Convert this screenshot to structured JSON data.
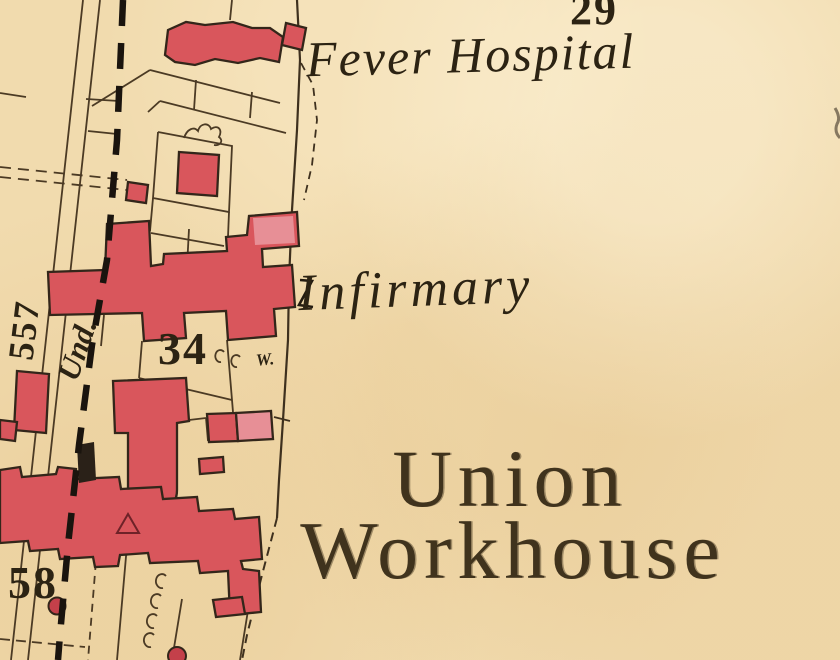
{
  "map": {
    "title_labels": {
      "fever_hospital": "Fever Hospital",
      "infirmary": "Infirmary",
      "union_workhouse_line1": "Union",
      "union_workhouse_line2": "Workhouse"
    },
    "parcel_numbers": {
      "parcel_29": "29",
      "parcel_34": "34",
      "parcel_557": "557",
      "parcel_58": "58"
    },
    "annotations": {
      "boundary_mereing": "Und.",
      "well": "W."
    },
    "colors": {
      "paper": "#f1dbae",
      "building_red": "#d9565c",
      "building_red_light": "#e78f96",
      "line_ink": "#4b3a24",
      "boundary_black": "#1a140e",
      "text_ink": "#2c2313"
    }
  }
}
